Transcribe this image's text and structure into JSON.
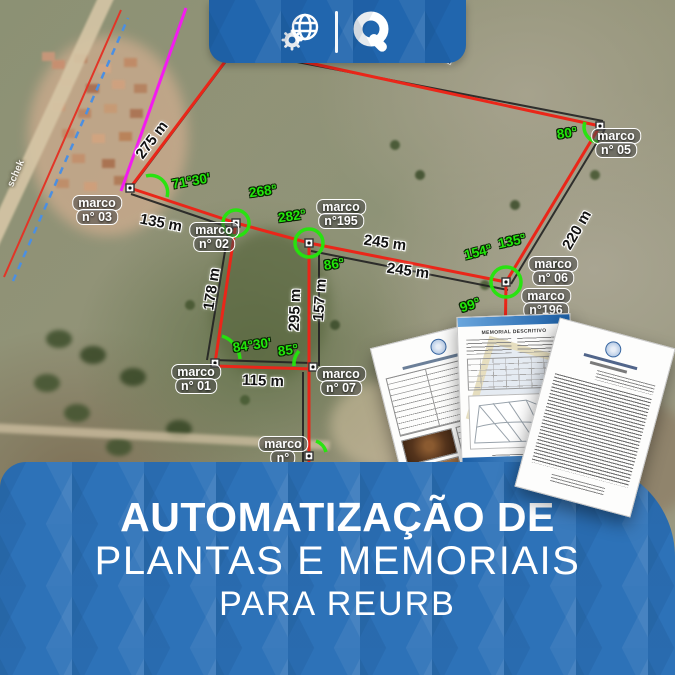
{
  "header": {
    "icons": {
      "left": "globe-gear",
      "right": "qgis-q"
    }
  },
  "map": {
    "road_label": "schek",
    "marcos": [
      {
        "lines": [
          "marco",
          "n° 03"
        ],
        "x": 97,
        "y": 211
      },
      {
        "lines": [
          "marco",
          "n° 02"
        ],
        "x": 214,
        "y": 238
      },
      {
        "lines": [
          "marco",
          "n°195"
        ],
        "x": 341,
        "y": 215
      },
      {
        "lines": [
          "marco",
          "n° 05"
        ],
        "x": 616,
        "y": 144
      },
      {
        "lines": [
          "marco",
          "n° 06"
        ],
        "x": 553,
        "y": 272
      },
      {
        "lines": [
          "marco",
          "n°196"
        ],
        "x": 546,
        "y": 304
      },
      {
        "lines": [
          "marco",
          "n° 01"
        ],
        "x": 196,
        "y": 380
      },
      {
        "lines": [
          "marco",
          "n° 07"
        ],
        "x": 341,
        "y": 382
      },
      {
        "lines": [
          "marco",
          "n°"
        ],
        "x": 283,
        "y": 452
      }
    ],
    "distances": [
      {
        "text": "275 m",
        "x": 152,
        "y": 140,
        "rot": -53
      },
      {
        "text": "135 m",
        "x": 161,
        "y": 223,
        "rot": 11
      },
      {
        "text": "245 m",
        "x": 385,
        "y": 243,
        "rot": 8
      },
      {
        "text": "245 m",
        "x": 408,
        "y": 271,
        "rot": 8
      },
      {
        "text": "220 m",
        "x": 577,
        "y": 230,
        "rot": -60
      },
      {
        "text": "178 m",
        "x": 212,
        "y": 289,
        "rot": -81
      },
      {
        "text": "295 m",
        "x": 295,
        "y": 310,
        "rot": -88
      },
      {
        "text": "157 m",
        "x": 320,
        "y": 300,
        "rot": -86
      },
      {
        "text": "115 m",
        "x": 263,
        "y": 381,
        "rot": 2
      },
      {
        "text": "m",
        "x": 447,
        "y": 57,
        "rot": 28
      }
    ],
    "angles": [
      {
        "text": "71°30'",
        "x": 191,
        "y": 181,
        "rot": -10
      },
      {
        "text": "268°",
        "x": 263,
        "y": 191,
        "rot": -8
      },
      {
        "text": "282°",
        "x": 292,
        "y": 216,
        "rot": -8
      },
      {
        "text": "86°",
        "x": 334,
        "y": 264,
        "rot": -8
      },
      {
        "text": "80°",
        "x": 567,
        "y": 133,
        "rot": -8
      },
      {
        "text": "135°",
        "x": 512,
        "y": 241,
        "rot": -12
      },
      {
        "text": "154°",
        "x": 478,
        "y": 252,
        "rot": -14
      },
      {
        "text": "99°",
        "x": 470,
        "y": 305,
        "rot": -18
      },
      {
        "text": "84°30'",
        "x": 252,
        "y": 345,
        "rot": -8
      },
      {
        "text": "85°",
        "x": 288,
        "y": 350,
        "rot": -8
      }
    ]
  },
  "documents": {
    "middle_title": "MEMORIAL DESCRITIVO"
  },
  "banner": {
    "line1": "AUTOMATIZAÇÃO DE",
    "line2": "PLANTAS E MEMORIAIS",
    "line3": "PARA REURB"
  },
  "colors": {
    "banner_blue": "#2d72b8",
    "survey_red": "#ea2619",
    "survey_green": "#23e70b",
    "magenta_line": "#f31bf0"
  }
}
